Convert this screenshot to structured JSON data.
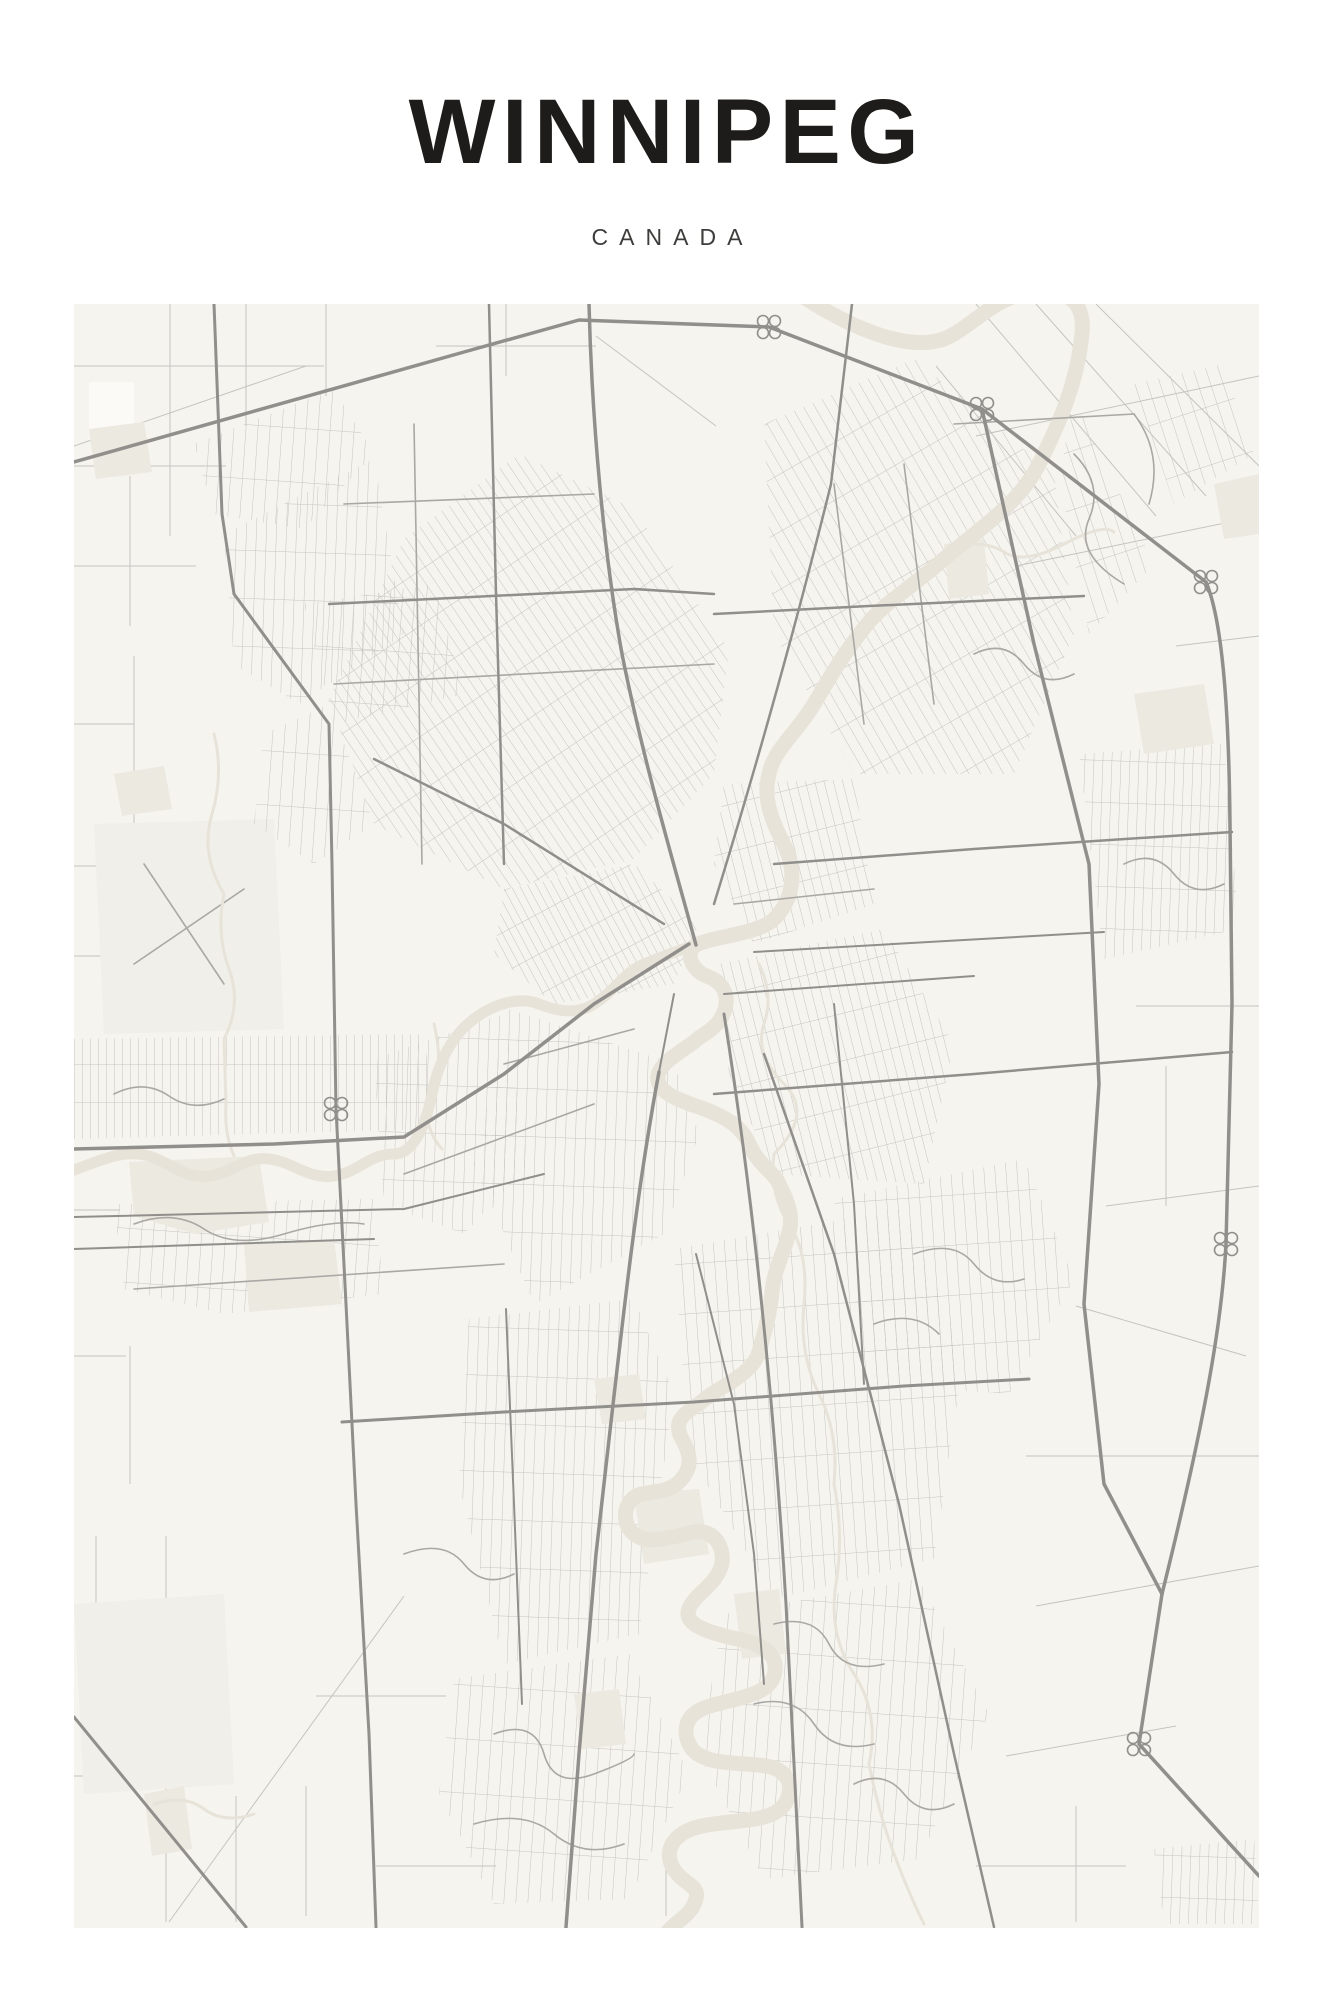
{
  "poster": {
    "title": "WINNIPEG",
    "subtitle": "CANADA"
  },
  "palette": {
    "pageBg": "#ffffff",
    "ink": "#1d1c1a",
    "subtitleInk": "#3e3d3b",
    "mapBg": "#f5f4ef",
    "water": "#e8e3d9",
    "park": "#ebe9e0",
    "field": "#f0efe9",
    "patchLight": "#fbfaf6",
    "roadMinor": "#c5c4c0",
    "roadMid": "#a9a8a4",
    "roadMajor": "#908f8c"
  }
}
